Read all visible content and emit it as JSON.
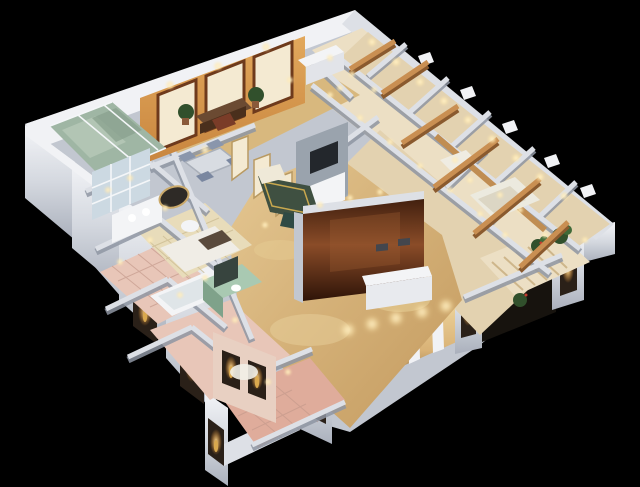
{
  "scene": {
    "description": "Isometric cutaway 3D render of a furnished apartment model on a black background",
    "style": "dollhouse floor-plan render with warm interior lighting",
    "rooms": [
      "top bedroom",
      "study",
      "dining area",
      "hallway",
      "master bedroom",
      "living room",
      "shower room",
      "mirror bathroom",
      "powder room",
      "pink-tile bathroom",
      "kitchenette",
      "guest bedrooms",
      "balcony",
      "entry corridor",
      "front colonnade"
    ]
  },
  "palette": {
    "background": "#000000",
    "wall_top": "#f1f2f5",
    "wall_light": "#dde0e6",
    "wall_mid": "#c2c7d0",
    "wall_shadow": "#8f96a3",
    "floor_cream": "#ecdfc4",
    "floor_cream2": "#e3d2b0",
    "floor_tan": "#d8b87e",
    "floor_gold": "#caa367",
    "tile_pink": "#e8c6b8",
    "tile_rose": "#dfac9b",
    "tatami": "#e8dcba",
    "mint": "#a9c9b2",
    "mint_dark": "#7fa28a",
    "glass_green": "#9fb6a4",
    "mirror_blue": "#ccd9e2",
    "wood_beam": "#c98f52",
    "wood_dark": "#8a5a2e",
    "study_wall": "#c8853e",
    "study_wall_light": "#e2a85c",
    "frame_cream": "#f4ead2",
    "frame_brown": "#6e3a1c",
    "tv_brown_dark": "#42200f",
    "tv_brown_mid": "#8a4c28",
    "tv_brown_deep": "#2e1408",
    "sofa_green": "#3f5041",
    "media_gray": "#9aa3ad",
    "tv_screen": "#23272c",
    "white_furn": "#f3f4f6",
    "glow_warm": "#ffe9b0",
    "glow_amber": "#ffc36a",
    "niche_dark": "#2a2018",
    "plant_green": "#31502c",
    "plant_red": "#c23b2e",
    "statue_gold": "#d9a84e"
  }
}
